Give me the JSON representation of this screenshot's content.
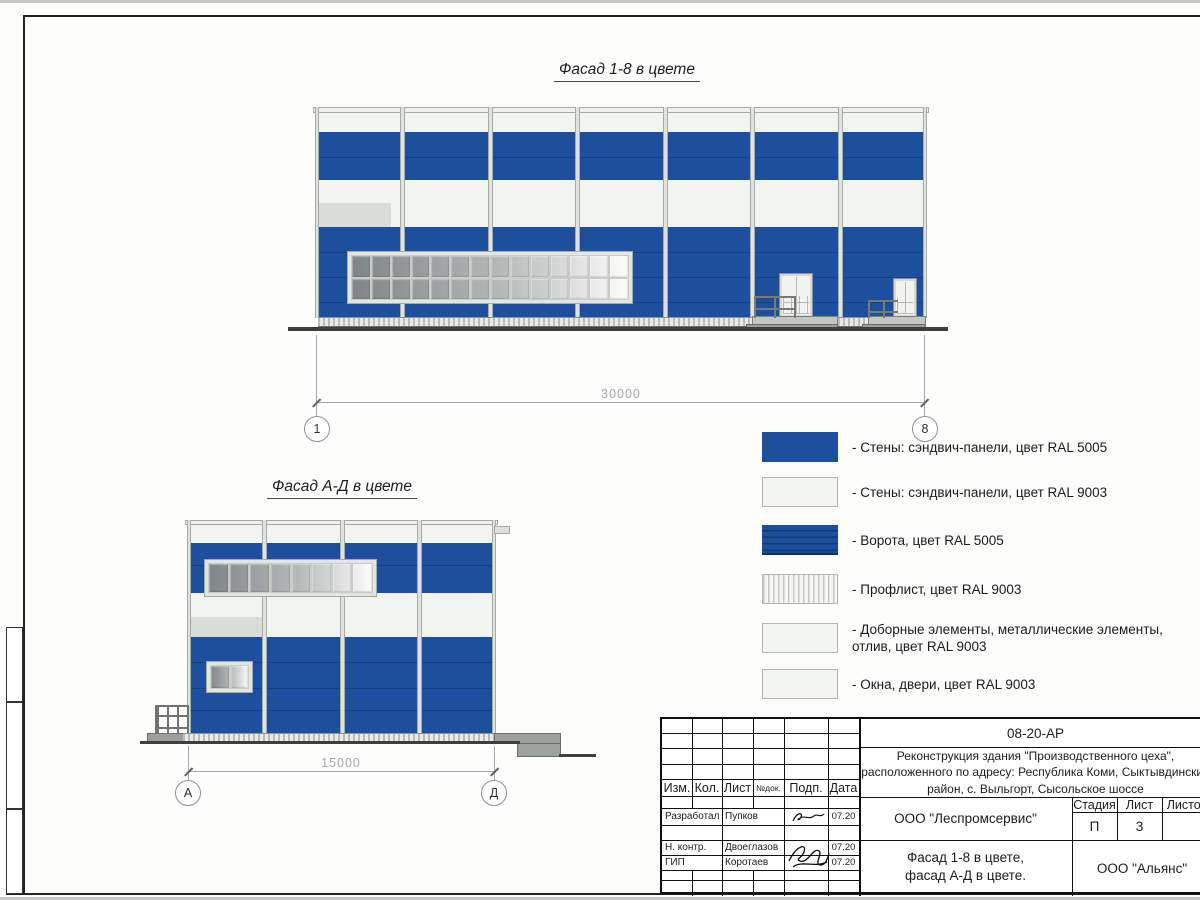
{
  "colors": {
    "blue_ral5005": "#1d4f9c",
    "blue_seam": "#16407f",
    "white_ral9003": "#f2f4f0",
    "white_seam": "#d9ddd7",
    "mullion": "#dfe2de",
    "mullion_edge": "#a6aba5",
    "dim_gray": "#a4a9ac",
    "ground_dark": "#3d403d",
    "step_gray": "#9da19c",
    "step_light": "#c3c6c2"
  },
  "figures": {
    "facade18": {
      "title": "Фасад 1-8 в цвете",
      "dim": "30000",
      "axis_left": "1",
      "axis_right": "8"
    },
    "facadeAD": {
      "title": "Фасад А-Д в цвете",
      "dim": "15000",
      "axis_left": "А",
      "axis_right": "Д"
    }
  },
  "legend": {
    "items": [
      {
        "type": "solid-blue",
        "label": "- Стены: сэндвич-панели, цвет RAL 5005"
      },
      {
        "type": "solid-white",
        "label": "- Стены: сэндвич-панели, цвет RAL 9003"
      },
      {
        "type": "gate-blue",
        "label": "- Ворота, цвет RAL 5005"
      },
      {
        "type": "hatch-vertical",
        "label": "- Профлист, цвет RAL 9003"
      },
      {
        "type": "solid-white",
        "label": "- Доборные элементы, металлические элементы, отлив, цвет RAL 9003"
      },
      {
        "type": "solid-white",
        "label": "- Окна, двери, цвет RAL 9003"
      }
    ]
  },
  "title_block": {
    "code": "08-20-АР",
    "project_lines": [
      "Реконструкция здания \"Производственного цеха\",",
      "расположенного по адресу: Республика Коми, Сыктывдинский",
      "район, с. Выльгорт, Сысольское шоссе"
    ],
    "columns": [
      "Изм.",
      "Кол.",
      "Лист",
      "№док.",
      "Подп.",
      "Дата"
    ],
    "staff": [
      {
        "role": "Разработал",
        "name": "Пупков",
        "date": "07.20"
      },
      {
        "role": "Н. контр.",
        "name": "Двоеглазов",
        "date": "07.20"
      },
      {
        "role": "ГИП",
        "name": "Коротаев",
        "date": "07.20"
      }
    ],
    "designer_org": "ООО \"Леспромсервис\"",
    "stage_cols": [
      "Стадия",
      "Лист",
      "Листов"
    ],
    "stage_vals": [
      "П",
      "3",
      ""
    ],
    "sheet_title_lines": [
      "Фасад 1-8 в цвете,",
      "фасад А-Д в цвете."
    ],
    "customer_org": "ООО \"Альянс\""
  }
}
